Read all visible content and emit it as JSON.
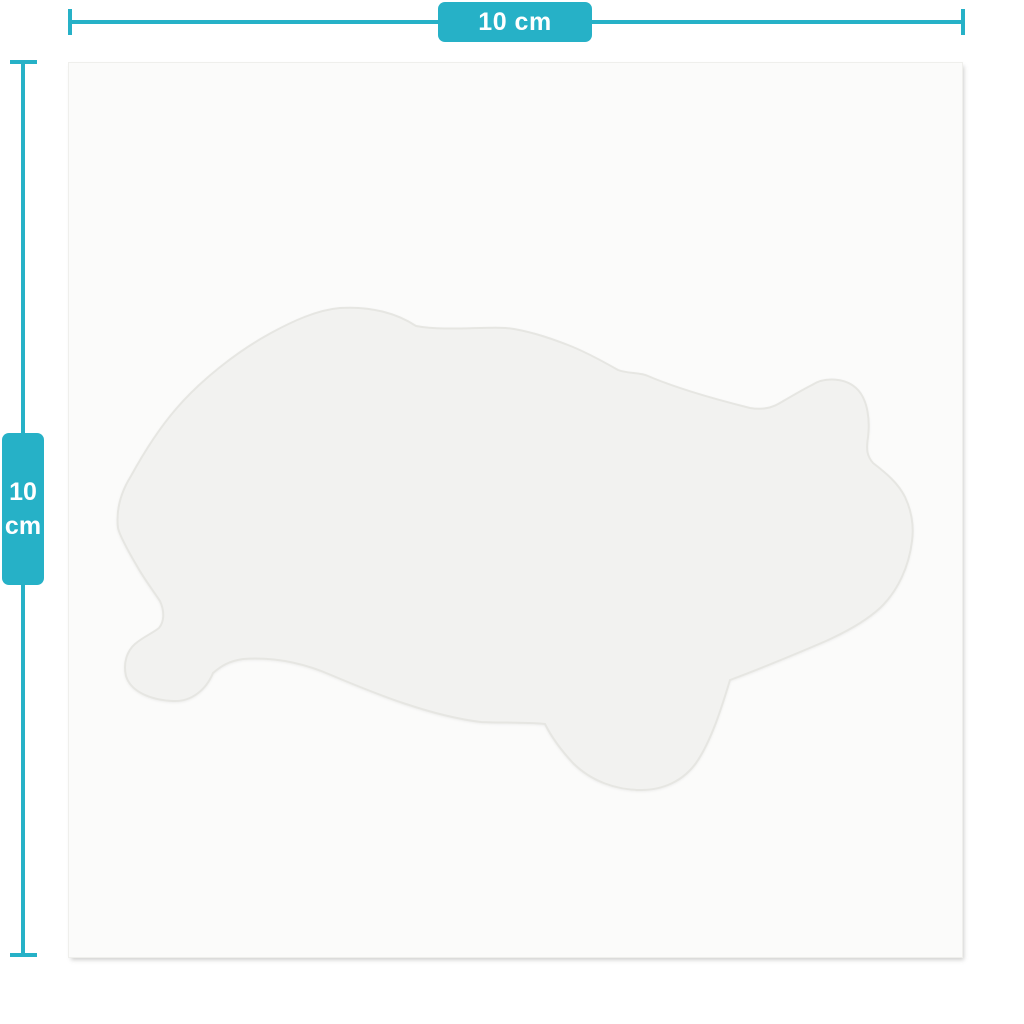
{
  "measurements": {
    "horizontal": {
      "label": "10 cm"
    },
    "vertical": {
      "value": "10",
      "unit": "cm"
    }
  },
  "colors": {
    "accent": "#26B1C7",
    "label_text": "#FFFFFF",
    "page_background": "#FFFFFF",
    "canvas_background": "#FBFBFA",
    "canvas_edge": "#EFEFEC",
    "shape_fill": "#F2F2F0",
    "shape_outline": "#E6E6E2"
  }
}
